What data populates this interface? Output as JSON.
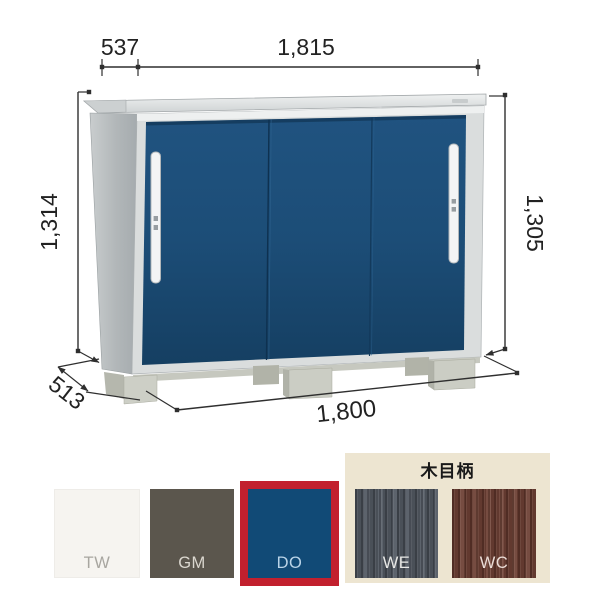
{
  "diagram": {
    "dimensions": {
      "top_depth": "537",
      "top_width": "1,815",
      "left_height": "1,314",
      "right_height": "1,305",
      "base_depth": "513",
      "base_width": "1,800"
    },
    "colors": {
      "door_blue": "#1c4d77",
      "frame_silver": "#dadddd",
      "side_panel_gray": "#b4b9bb",
      "foot_beige": "#cbcdc4",
      "annotation": "#2f2f2f"
    }
  },
  "swatches": {
    "wood_group_label": "木目柄",
    "selected_code": "DO",
    "selection_border_color": "#c2202e",
    "panel_bg": "#ede5d1",
    "items": [
      {
        "code": "TW",
        "color": "#f6f4f0",
        "label_color": "#a8a6a0",
        "type": "solid",
        "selected": false
      },
      {
        "code": "GM",
        "color": "#5b564d",
        "label_color": "#dbd7cf",
        "type": "solid",
        "selected": false
      },
      {
        "code": "DO",
        "color": "#114a76",
        "label_color": "#bad4e8",
        "type": "solid",
        "selected": true
      },
      {
        "code": "WE",
        "color": "#565d66",
        "label_color": "#e7e7e5",
        "type": "wood",
        "selected": false
      },
      {
        "code": "WC",
        "color": "#6f4237",
        "label_color": "#eadcd6",
        "type": "wood",
        "selected": false
      }
    ]
  }
}
